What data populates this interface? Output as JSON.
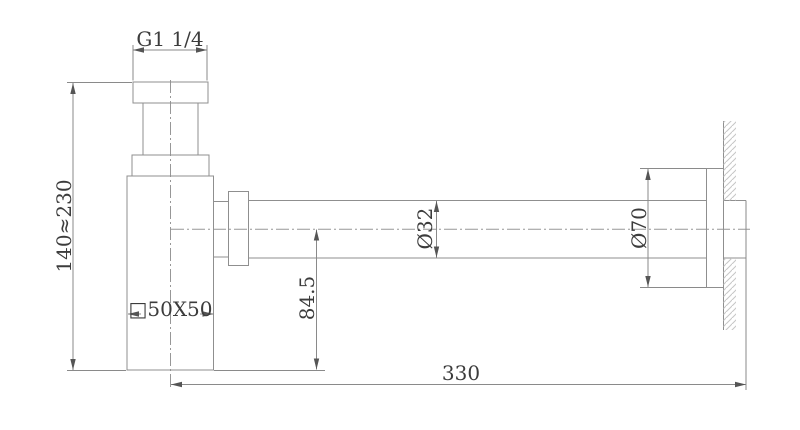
{
  "drawing": {
    "type": "technical-drawing",
    "subject": "bottle-trap-siphon-side-view",
    "background_color": "#ffffff",
    "line_color": "#8f8f8f",
    "text_color": "#3c3c3c",
    "hatch_color": "#c6c6c6",
    "dimensions": {
      "inlet_thread": "G1 1/4",
      "height_range": "140≈230",
      "body_section": "□50X50",
      "trap_depth": "84.5",
      "pipe_diameter": "Ø32",
      "flange_diameter": "Ø70",
      "wall_distance": "330"
    }
  }
}
